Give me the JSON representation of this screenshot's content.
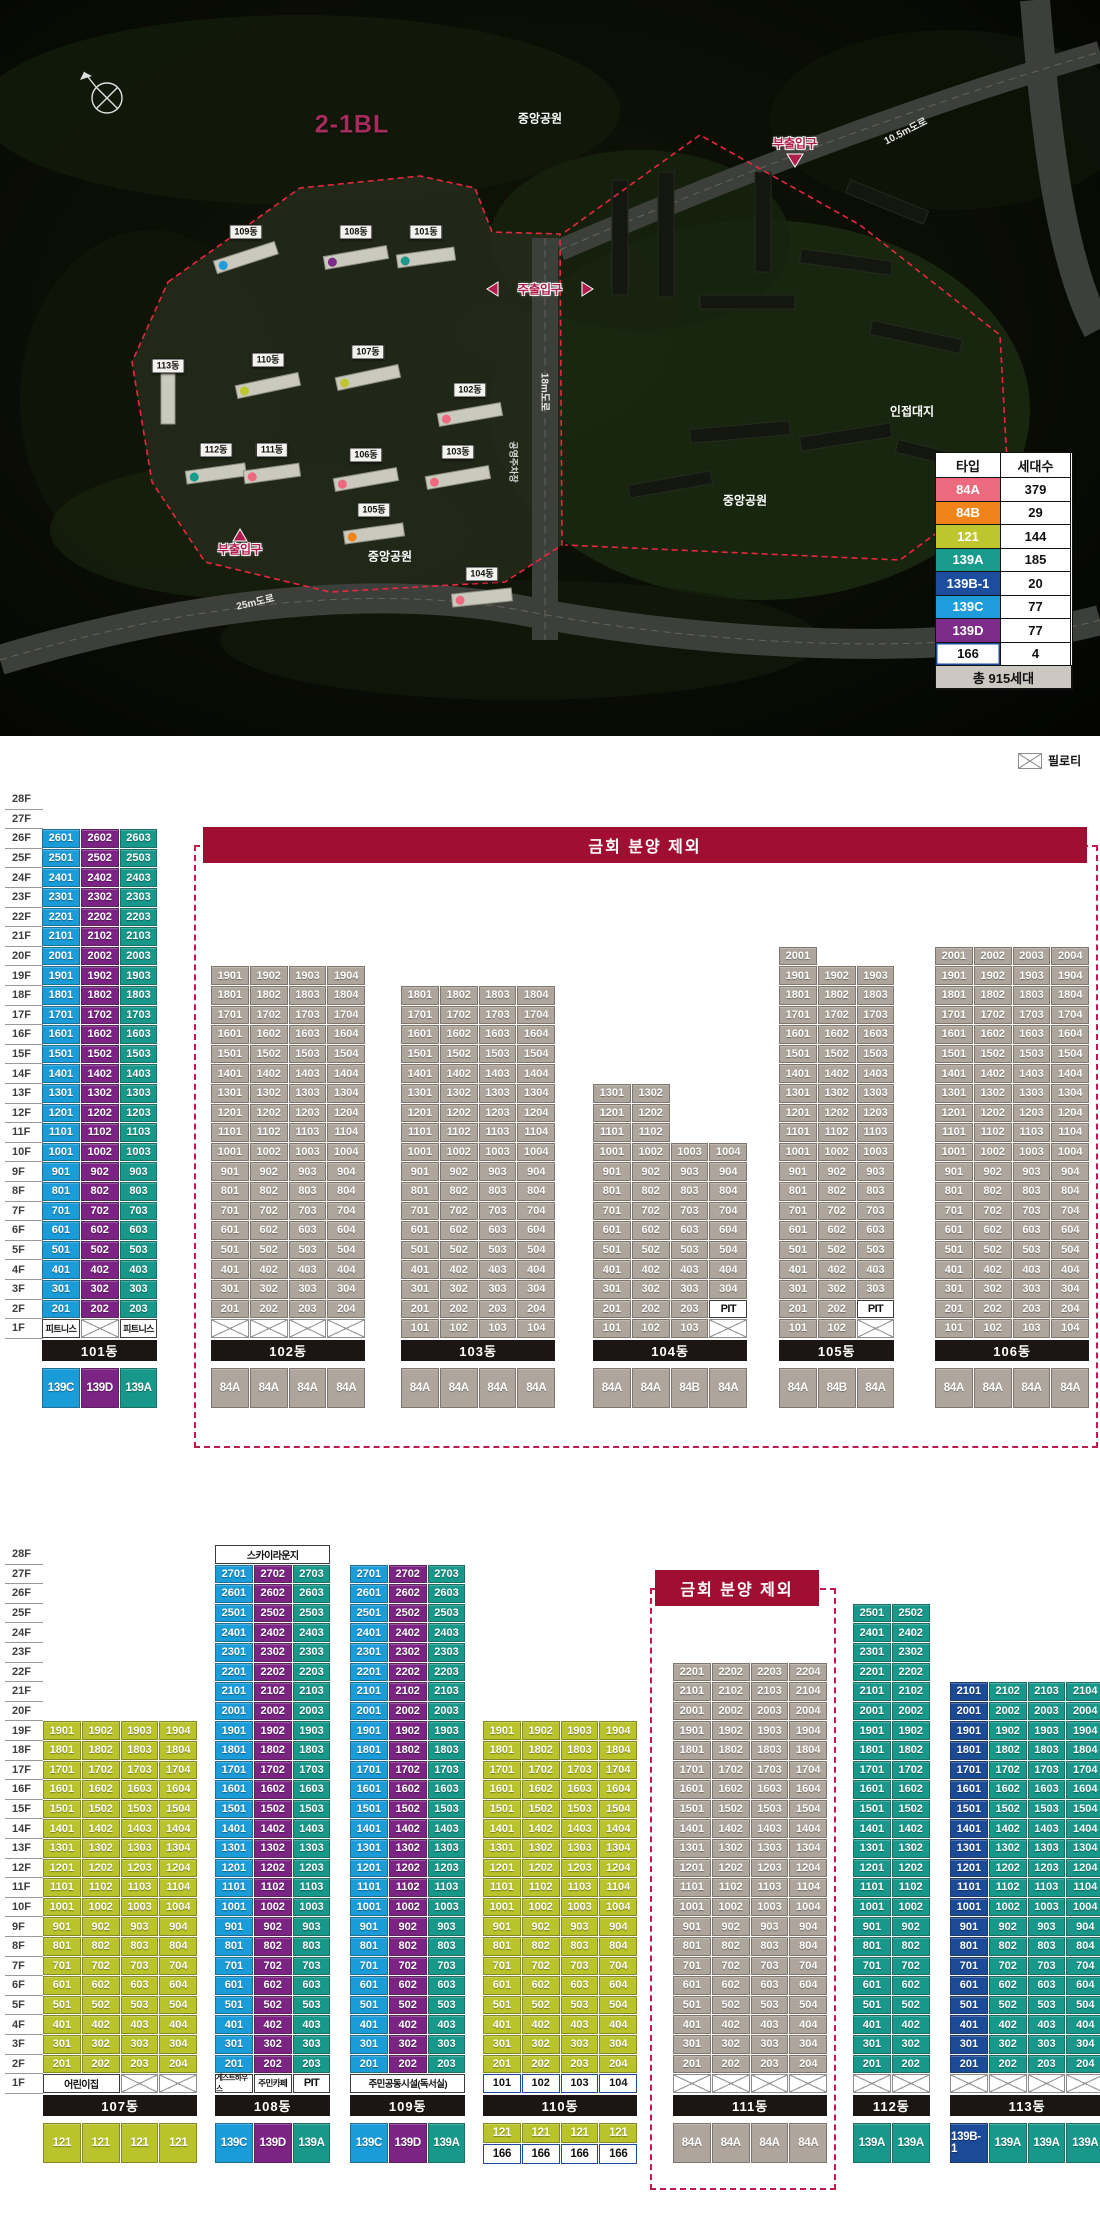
{
  "site_plan": {
    "block_label": "2-1BL",
    "text_labels": [
      {
        "t": "중앙공원",
        "x": 540,
        "y": 118,
        "c": "#ffffff",
        "s": 12,
        "r": 0,
        "o": false
      },
      {
        "t": "부출입구",
        "x": 795,
        "y": 143,
        "c": "#b01e4e",
        "s": 12,
        "r": 0,
        "o": true
      },
      {
        "t": "10.5m도로",
        "x": 905,
        "y": 130,
        "c": "#e8e8e8",
        "s": 10,
        "r": -27,
        "o": false
      },
      {
        "t": "인접대지",
        "x": 912,
        "y": 411,
        "c": "#ffffff",
        "s": 12,
        "r": 0,
        "o": false
      },
      {
        "t": "중앙공원",
        "x": 745,
        "y": 500,
        "c": "#ffffff",
        "s": 12,
        "r": 0,
        "o": false
      },
      {
        "t": "중앙공원",
        "x": 390,
        "y": 556,
        "c": "#ffffff",
        "s": 12,
        "r": 0,
        "o": false
      },
      {
        "t": "주출입구",
        "x": 540,
        "y": 289,
        "c": "#b01e4e",
        "s": 12,
        "r": 0,
        "o": true
      },
      {
        "t": "부출입구",
        "x": 240,
        "y": 549,
        "c": "#b01e4e",
        "s": 12,
        "r": 0,
        "o": true
      },
      {
        "t": "25m도로",
        "x": 255,
        "y": 601,
        "c": "#e8e8e8",
        "s": 10,
        "r": -13,
        "o": false
      },
      {
        "t": "18m도로",
        "x": 546,
        "y": 392,
        "c": "#e8e8e8",
        "s": 10,
        "r": 90,
        "o": false
      },
      {
        "t": "공영주차장",
        "x": 514,
        "y": 462,
        "c": "#d8d8d8",
        "s": 9,
        "r": 90,
        "o": false
      }
    ],
    "building_chips": [
      {
        "t": "109동",
        "x": 246,
        "y": 232
      },
      {
        "t": "108동",
        "x": 356,
        "y": 232
      },
      {
        "t": "101동",
        "x": 426,
        "y": 232
      },
      {
        "t": "113동",
        "x": 168,
        "y": 366
      },
      {
        "t": "110동",
        "x": 268,
        "y": 360
      },
      {
        "t": "107동",
        "x": 368,
        "y": 352
      },
      {
        "t": "102동",
        "x": 470,
        "y": 390
      },
      {
        "t": "112동",
        "x": 216,
        "y": 450
      },
      {
        "t": "111동",
        "x": 272,
        "y": 450
      },
      {
        "t": "106동",
        "x": 366,
        "y": 455
      },
      {
        "t": "103동",
        "x": 458,
        "y": 452
      },
      {
        "t": "105동",
        "x": 374,
        "y": 510
      },
      {
        "t": "104동",
        "x": 482,
        "y": 574
      }
    ],
    "legend": {
      "x": 935,
      "y": 452,
      "col_w": [
        66,
        71
      ],
      "row_h": 24.5,
      "header": [
        "타입",
        "세대수"
      ],
      "rows": [
        {
          "type": "84A",
          "count": "379",
          "bg": "#ED6A7E",
          "fg": "#fff"
        },
        {
          "type": "84B",
          "count": "29",
          "bg": "#F08418",
          "fg": "#fff"
        },
        {
          "type": "121",
          "count": "144",
          "bg": "#BDC62C",
          "fg": "#fff"
        },
        {
          "type": "139A",
          "count": "185",
          "bg": "#189A8D",
          "fg": "#fff"
        },
        {
          "type": "139B-1",
          "count": "20",
          "bg": "#1D4D9D",
          "fg": "#fff"
        },
        {
          "type": "139C",
          "count": "77",
          "bg": "#1F9CDB",
          "fg": "#fff"
        },
        {
          "type": "139D",
          "count": "77",
          "bg": "#7D2B89",
          "fg": "#fff"
        },
        {
          "type": "166",
          "count": "4",
          "bg": "#FFFFFF",
          "fg": "#111",
          "border": "#1C4C99"
        }
      ],
      "total": "총 915세대"
    }
  },
  "pilotis_legend_label": "필로티",
  "floor_labels": [
    "28F",
    "27F",
    "26F",
    "25F",
    "24F",
    "23F",
    "22F",
    "21F",
    "20F",
    "19F",
    "18F",
    "17F",
    "16F",
    "15F",
    "14F",
    "13F",
    "12F",
    "11F",
    "10F",
    "9F",
    "8F",
    "7F",
    "6F",
    "5F",
    "4F",
    "3F",
    "2F",
    "1F"
  ],
  "type_colors": {
    "84A": {
      "bg": "#AEA69C",
      "fg": "#fff"
    },
    "84B": {
      "bg": "#AEA69C",
      "fg": "#fff"
    },
    "121": {
      "bg": "#B9C32B",
      "fg": "#fff"
    },
    "139A": {
      "bg": "#17988A",
      "fg": "#fff"
    },
    "139B-1": {
      "bg": "#1B4B97",
      "fg": "#fff"
    },
    "139C": {
      "bg": "#1A9CD8",
      "fg": "#fff"
    },
    "139D": {
      "bg": "#7B2484",
      "fg": "#fff"
    },
    "166": {
      "bg": "#FFFFFF",
      "fg": "#111",
      "border": "#1C4C99"
    }
  },
  "sections": [
    {
      "top_y": 790,
      "pilotis_legend": {
        "x": 1018,
        "y": 752
      },
      "banner": {
        "text": "금회 분양 제외",
        "x": 203,
        "y": 827,
        "w": 884,
        "h": 36
      },
      "box": {
        "x": 194,
        "y": 845,
        "w": 904,
        "h": 603
      },
      "buildings": [
        {
          "name": "101동",
          "x": 42,
          "cols": [
            "139C",
            "139D",
            "139A"
          ],
          "ranges": [
            [
              2,
              26
            ],
            [
              2,
              26
            ],
            [
              2,
              26
            ]
          ],
          "specials": [
            {
              "f": 1,
              "c": 1,
              "kind": "amenity",
              "label": "피트니스",
              "fs": 9
            },
            {
              "f": 1,
              "c": 2,
              "kind": "pilotis"
            },
            {
              "f": 1,
              "c": 3,
              "kind": "amenity",
              "label": "피트니스",
              "fs": 9
            }
          ],
          "types": [
            [
              "139C",
              "139D",
              "139A"
            ]
          ]
        },
        {
          "name": "102동",
          "x": 211,
          "cols": [
            "84A",
            "84A",
            "84A",
            "84A"
          ],
          "ranges": [
            [
              2,
              19
            ],
            [
              2,
              19
            ],
            [
              2,
              19
            ],
            [
              2,
              19
            ]
          ],
          "specials": [
            {
              "f": 1,
              "c": 1,
              "kind": "pilotis"
            },
            {
              "f": 1,
              "c": 2,
              "kind": "pilotis"
            },
            {
              "f": 1,
              "c": 3,
              "kind": "pilotis"
            },
            {
              "f": 1,
              "c": 4,
              "kind": "pilotis"
            }
          ],
          "types": [
            [
              "84A",
              "84A",
              "84A",
              "84A"
            ]
          ]
        },
        {
          "name": "103동",
          "x": 401,
          "cols": [
            "84A",
            "84A",
            "84A",
            "84A"
          ],
          "ranges": [
            [
              1,
              18
            ],
            [
              1,
              18
            ],
            [
              1,
              18
            ],
            [
              1,
              18
            ]
          ],
          "specials": [],
          "types": [
            [
              "84A",
              "84A",
              "84A",
              "84A"
            ]
          ]
        },
        {
          "name": "104동",
          "x": 593,
          "cols": [
            "84A",
            "84A",
            "84B",
            "84A"
          ],
          "ranges": [
            [
              1,
              13
            ],
            [
              1,
              13
            ],
            [
              1,
              10
            ],
            [
              3,
              10
            ]
          ],
          "specials": [
            {
              "f": 2,
              "c": 4,
              "kind": "amenity",
              "label": "PIT",
              "fs": 11
            },
            {
              "f": 1,
              "c": 4,
              "kind": "pilotis"
            }
          ],
          "types": [
            [
              "84A",
              "84A",
              "84B",
              "84A"
            ]
          ]
        },
        {
          "name": "105동",
          "x": 779,
          "cols": [
            "84A",
            "84B",
            "84A"
          ],
          "ranges": [
            [
              1,
              20
            ],
            [
              1,
              19
            ],
            [
              3,
              19
            ]
          ],
          "specials": [
            {
              "f": 2,
              "c": 3,
              "kind": "amenity",
              "label": "PIT",
              "fs": 11
            },
            {
              "f": 1,
              "c": 3,
              "kind": "pilotis"
            }
          ],
          "types": [
            [
              "84A",
              "84B",
              "84A"
            ]
          ]
        },
        {
          "name": "106동",
          "x": 935,
          "cols": [
            "84A",
            "84A",
            "84A",
            "84A"
          ],
          "ranges": [
            [
              1,
              20
            ],
            [
              1,
              20
            ],
            [
              1,
              20
            ],
            [
              1,
              20
            ]
          ],
          "specials": [],
          "types": [
            [
              "84A",
              "84A",
              "84A",
              "84A"
            ]
          ]
        }
      ]
    },
    {
      "top_y": 1545,
      "banner": {
        "text": "금회 분양 제외",
        "x": 655,
        "y": 1570,
        "w": 164,
        "h": 36
      },
      "box": {
        "x": 650,
        "y": 1588,
        "w": 186,
        "h": 602
      },
      "buildings": [
        {
          "name": "107동",
          "x": 43,
          "cols": [
            "121",
            "121",
            "121",
            "121"
          ],
          "ranges": [
            [
              2,
              19
            ],
            [
              2,
              19
            ],
            [
              2,
              19
            ],
            [
              2,
              19
            ]
          ],
          "specials": [
            {
              "f": 1,
              "c": 1,
              "span": 2,
              "kind": "amenity",
              "label": "어린이집",
              "fs": 10
            },
            {
              "f": 1,
              "c": 3,
              "kind": "pilotis"
            },
            {
              "f": 1,
              "c": 4,
              "kind": "pilotis"
            }
          ],
          "types": [
            [
              "121",
              "121",
              "121",
              "121"
            ]
          ]
        },
        {
          "name": "108동",
          "x": 215,
          "cols": [
            "139C",
            "139D",
            "139A"
          ],
          "ranges": [
            [
              2,
              27
            ],
            [
              2,
              27
            ],
            [
              2,
              27
            ]
          ],
          "specials": [
            {
              "f": 28,
              "c": 1,
              "span": 3,
              "kind": "amenity",
              "label": "스카이라운지",
              "fs": 10
            },
            {
              "f": 1,
              "c": 1,
              "kind": "amenity",
              "label": "게스트하우스",
              "fs": 7.5
            },
            {
              "f": 1,
              "c": 2,
              "kind": "amenity",
              "label": "주민카페",
              "fs": 8.5
            },
            {
              "f": 1,
              "c": 3,
              "kind": "amenity",
              "label": "PIT",
              "fs": 11
            }
          ],
          "types": [
            [
              "139C",
              "139D",
              "139A"
            ]
          ]
        },
        {
          "name": "109동",
          "x": 350,
          "cols": [
            "139C",
            "139D",
            "139A"
          ],
          "ranges": [
            [
              2,
              27
            ],
            [
              2,
              27
            ],
            [
              2,
              27
            ]
          ],
          "specials": [
            {
              "f": 1,
              "c": 1,
              "span": 3,
              "kind": "amenity",
              "label": "주민공동시설(독서실)",
              "fs": 9.5
            }
          ],
          "types": [
            [
              "139C",
              "139D",
              "139A"
            ]
          ]
        },
        {
          "name": "110동",
          "x": 483,
          "cols": [
            "121",
            "121",
            "121",
            "121"
          ],
          "ranges": [
            [
              2,
              19
            ],
            [
              2,
              19
            ],
            [
              2,
              19
            ],
            [
              2,
              19
            ]
          ],
          "specials": [
            {
              "f": 1,
              "c": 1,
              "kind": "unit166"
            },
            {
              "f": 1,
              "c": 2,
              "kind": "unit166"
            },
            {
              "f": 1,
              "c": 3,
              "kind": "unit166"
            },
            {
              "f": 1,
              "c": 4,
              "kind": "unit166"
            }
          ],
          "types": [
            [
              "121",
              "121",
              "121",
              "121"
            ],
            [
              "166",
              "166",
              "166",
              "166"
            ]
          ]
        },
        {
          "name": "111동",
          "x": 673,
          "cols": [
            "84A",
            "84A",
            "84A",
            "84A"
          ],
          "ranges": [
            [
              2,
              22
            ],
            [
              2,
              22
            ],
            [
              2,
              22
            ],
            [
              2,
              22
            ]
          ],
          "specials": [
            {
              "f": 1,
              "c": 1,
              "kind": "pilotis"
            },
            {
              "f": 1,
              "c": 2,
              "kind": "pilotis"
            },
            {
              "f": 1,
              "c": 3,
              "kind": "pilotis"
            },
            {
              "f": 1,
              "c": 4,
              "kind": "pilotis"
            }
          ],
          "types": [
            [
              "84A",
              "84A",
              "84A",
              "84A"
            ]
          ]
        },
        {
          "name": "112동",
          "x": 853,
          "cols": [
            "139A",
            "139A"
          ],
          "ranges": [
            [
              2,
              25
            ],
            [
              2,
              25
            ]
          ],
          "specials": [
            {
              "f": 1,
              "c": 1,
              "kind": "pilotis"
            },
            {
              "f": 1,
              "c": 2,
              "kind": "pilotis"
            }
          ],
          "types": [
            [
              "139A",
              "139A"
            ]
          ]
        },
        {
          "name": "113동",
          "x": 950,
          "cols": [
            "139B-1",
            "139A",
            "139A",
            "139A"
          ],
          "ranges": [
            [
              2,
              21
            ],
            [
              2,
              21
            ],
            [
              2,
              21
            ],
            [
              2,
              21
            ]
          ],
          "specials": [
            {
              "f": 1,
              "c": 1,
              "kind": "pilotis"
            },
            {
              "f": 1,
              "c": 2,
              "kind": "pilotis"
            },
            {
              "f": 1,
              "c": 3,
              "kind": "pilotis"
            },
            {
              "f": 1,
              "c": 4,
              "kind": "pilotis"
            }
          ],
          "types": [
            [
              "139B-1",
              "139A",
              "139A",
              "139A"
            ]
          ]
        }
      ]
    }
  ]
}
